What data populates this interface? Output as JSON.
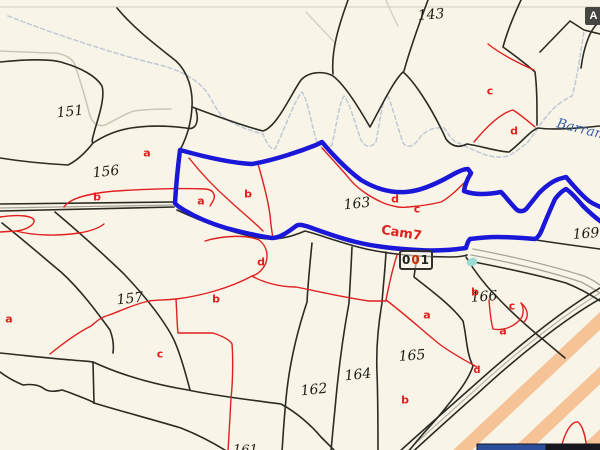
{
  "map": {
    "background_color": "#f8f5e8",
    "toolbar_button": {
      "label": "A"
    },
    "stream_label": {
      "text": "Barran"
    },
    "road_label": {
      "text": "Cam7"
    },
    "highlight_label": {
      "digits": [
        "0",
        "0",
        "1"
      ],
      "digit_colors": [
        "#1f1f1f",
        "#cf2a00",
        "#1f1f1f"
      ]
    },
    "clipped_label": {
      "text": "161"
    },
    "parcel_numbers": [
      {
        "text": "143",
        "x": 431,
        "y": 15,
        "rot": -4
      },
      {
        "text": "151",
        "x": 70,
        "y": 112,
        "rot": -6
      },
      {
        "text": "156",
        "x": 106,
        "y": 172,
        "rot": -6
      },
      {
        "text": "157",
        "x": 130,
        "y": 299,
        "rot": -6
      },
      {
        "text": "162",
        "x": 314,
        "y": 390,
        "rot": -6
      },
      {
        "text": "163",
        "x": 357,
        "y": 204,
        "rot": -6
      },
      {
        "text": "164",
        "x": 358,
        "y": 375,
        "rot": -6
      },
      {
        "text": "165",
        "x": 412,
        "y": 356,
        "rot": -4
      },
      {
        "text": "166",
        "x": 484,
        "y": 297,
        "rot": -4
      },
      {
        "text": "169",
        "x": 586,
        "y": 234,
        "rot": -4
      }
    ],
    "subparcel_labels": [
      {
        "text": "a",
        "x": 147,
        "y": 153
      },
      {
        "text": "b",
        "x": 97,
        "y": 197
      },
      {
        "text": "a",
        "x": 201,
        "y": 201
      },
      {
        "text": "b",
        "x": 248,
        "y": 194
      },
      {
        "text": "c",
        "x": 490,
        "y": 91
      },
      {
        "text": "d",
        "x": 514,
        "y": 131
      },
      {
        "text": "d",
        "x": 395,
        "y": 199
      },
      {
        "text": "c",
        "x": 417,
        "y": 209
      },
      {
        "text": "d",
        "x": 261,
        "y": 262
      },
      {
        "text": "b",
        "x": 216,
        "y": 299
      },
      {
        "text": "a",
        "x": 9,
        "y": 319
      },
      {
        "text": "c",
        "x": 160,
        "y": 354
      },
      {
        "text": "a",
        "x": 427,
        "y": 315
      },
      {
        "text": "b",
        "x": 405,
        "y": 400
      },
      {
        "text": "b",
        "x": 475,
        "y": 292
      },
      {
        "text": "c",
        "x": 512,
        "y": 306
      },
      {
        "text": "a",
        "x": 503,
        "y": 331
      },
      {
        "text": "d",
        "x": 477,
        "y": 371,
        "small": true
      }
    ],
    "colors": {
      "boundary_black": "#2b2b23",
      "subparcel_red": "#e01f1f",
      "highlight_blue": "#1a17d8",
      "stream_dash": "#c4cbd6",
      "topo_gray": "#cbc7b6",
      "road_gray": "#a7a396",
      "highway_orange": "#f6c193",
      "water_teal": "#9adbd3",
      "legend_navy": "#2c4f9c",
      "stream_text_blue": "#3a5fa8"
    }
  }
}
